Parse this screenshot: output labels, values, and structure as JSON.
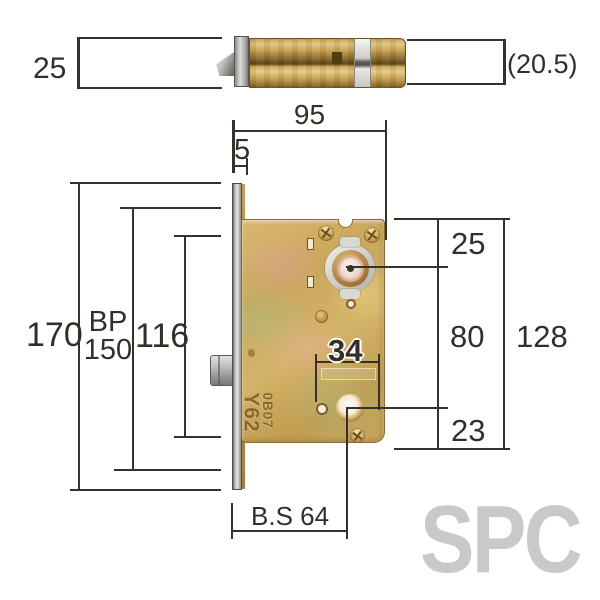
{
  "top_view": {
    "dim_height": "25",
    "dim_depth": "(20.5)"
  },
  "front_view": {
    "dim_width": "95",
    "dim_offset": "5",
    "dim_left_outer": "170",
    "dim_left_bp": "BP",
    "dim_left_bp_value": "150",
    "dim_left_inner": "116",
    "dim_right_top": "25",
    "dim_right_mid": "80",
    "dim_right_bottom": "23",
    "dim_right_outer": "128",
    "dim_hole_span": "34",
    "dim_backset": "B.S 64",
    "stamp_line1": "Y62",
    "stamp_line2": "0B07"
  },
  "watermark": "SPC",
  "colors": {
    "line": "#38302a",
    "brass": "#c9a75c",
    "steel": "#c6c6c4",
    "watermark": "#c9c9c9"
  }
}
